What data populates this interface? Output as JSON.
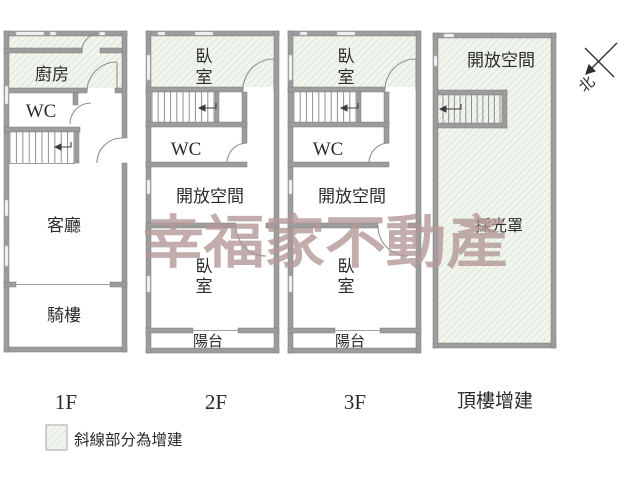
{
  "watermark": "幸福家不動產",
  "compass_north": "北",
  "legend_text": "斜線部分為增建",
  "floors": {
    "f1": {
      "label": "1F",
      "kitchen": "廚房",
      "wc": "WC",
      "living": "客廳",
      "arcade": "騎樓"
    },
    "f2": {
      "label": "2F",
      "bedroom_l1": "臥",
      "bedroom_l2": "室",
      "wc": "WC",
      "open_space": "開放空間",
      "balcony": "陽台"
    },
    "f3": {
      "label": "3F",
      "bedroom_l1": "臥",
      "bedroom_l2": "室",
      "wc": "WC",
      "open_space": "開放空間",
      "balcony": "陽台"
    },
    "roof": {
      "label": "頂樓增建",
      "open_space": "開放空間",
      "skylight": "採光罩"
    }
  },
  "colors": {
    "wall": "#9c9c9c",
    "addition_fill": "#f1f5ed",
    "addition_line": "#d9e4d1",
    "watermark": "#b39898",
    "text": "#2b2b2b"
  }
}
